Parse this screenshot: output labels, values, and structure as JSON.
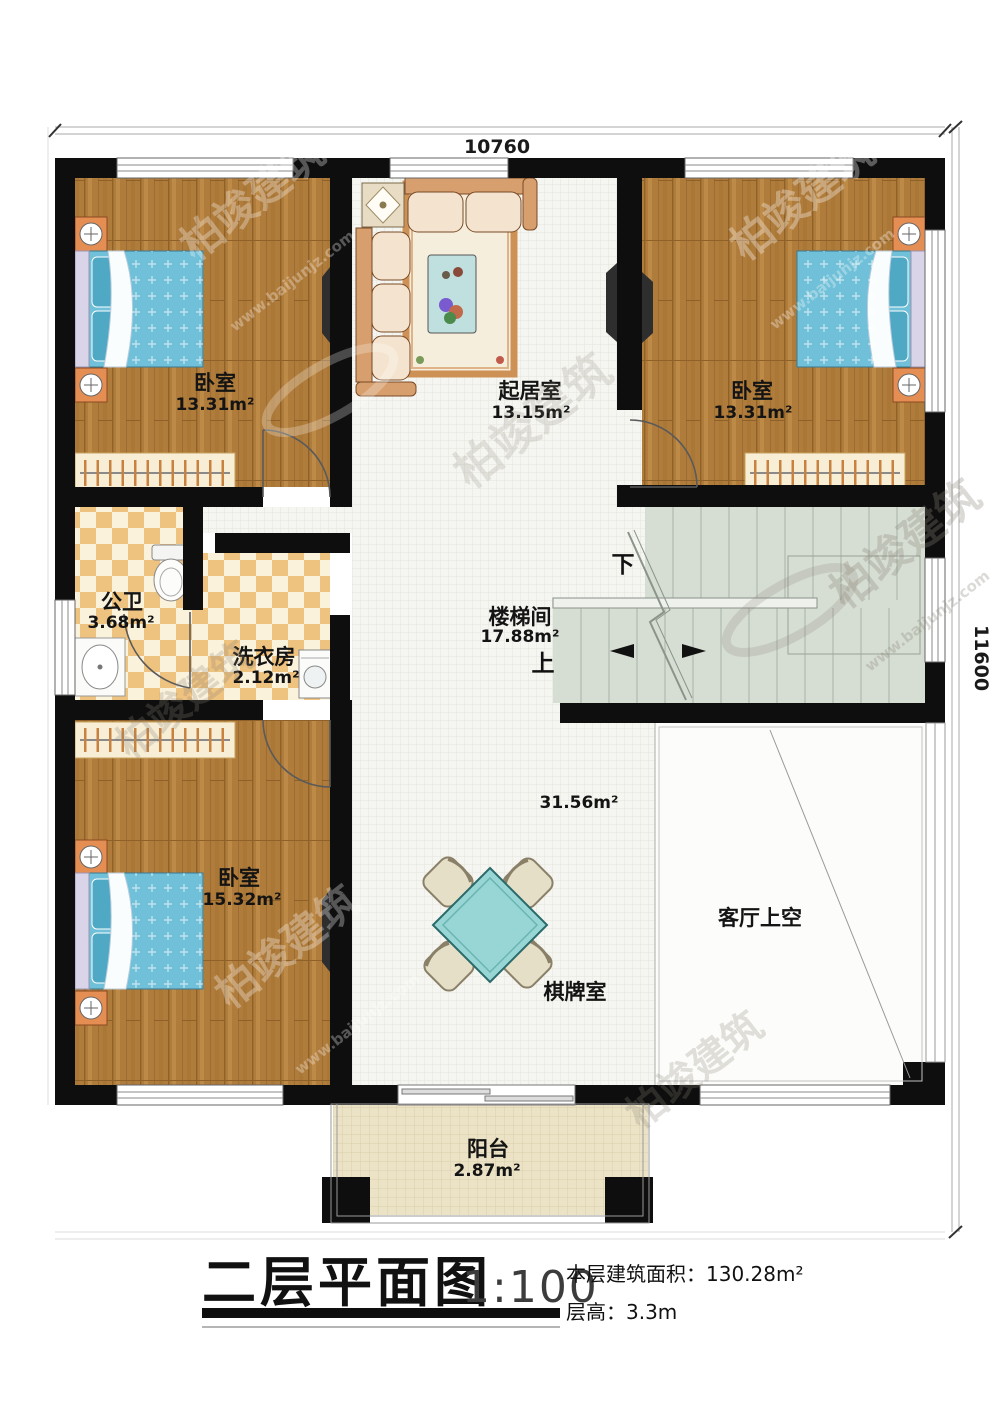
{
  "dimensions": {
    "top": "10760",
    "right": "11600"
  },
  "rooms": {
    "bedroom_tl": {
      "name": "卧室",
      "area": "13.31m²"
    },
    "living": {
      "name": "起居室",
      "area": "13.15m²"
    },
    "bedroom_tr": {
      "name": "卧室",
      "area": "13.31m²"
    },
    "bathroom": {
      "name": "公卫",
      "area": "3.68m²"
    },
    "laundry": {
      "name": "洗衣房",
      "area": "2.12m²"
    },
    "stairs": {
      "name": "楼梯间",
      "area": "17.88m²",
      "down": "下",
      "up": "上"
    },
    "games": {
      "name": "棋牌室",
      "area": "31.56m²"
    },
    "void": {
      "name": "客厅上空"
    },
    "bedroom_b": {
      "name": "卧室",
      "area": "15.32m²"
    },
    "balcony": {
      "name": "阳台",
      "area": "2.87m²"
    }
  },
  "titleblock": {
    "title": "二层平面图",
    "scale": "1:100",
    "area_label": "本层建筑面积：130.28m²",
    "height_label": "层高：3.3m"
  },
  "watermark": {
    "brand": "柏竣建筑",
    "url": "www.baijunjz.com"
  },
  "colors": {
    "wall": "#0e0e0e",
    "wood_floor": "#b07c3c",
    "tile_orange": "#eec27f",
    "tile_cream": "#fbf2dc",
    "stair_floor": "#d6ddd2",
    "bed_blue": "#6fc0d8",
    "balcony_floor": "#ece3c6",
    "table_teal": "#97d6d4"
  }
}
